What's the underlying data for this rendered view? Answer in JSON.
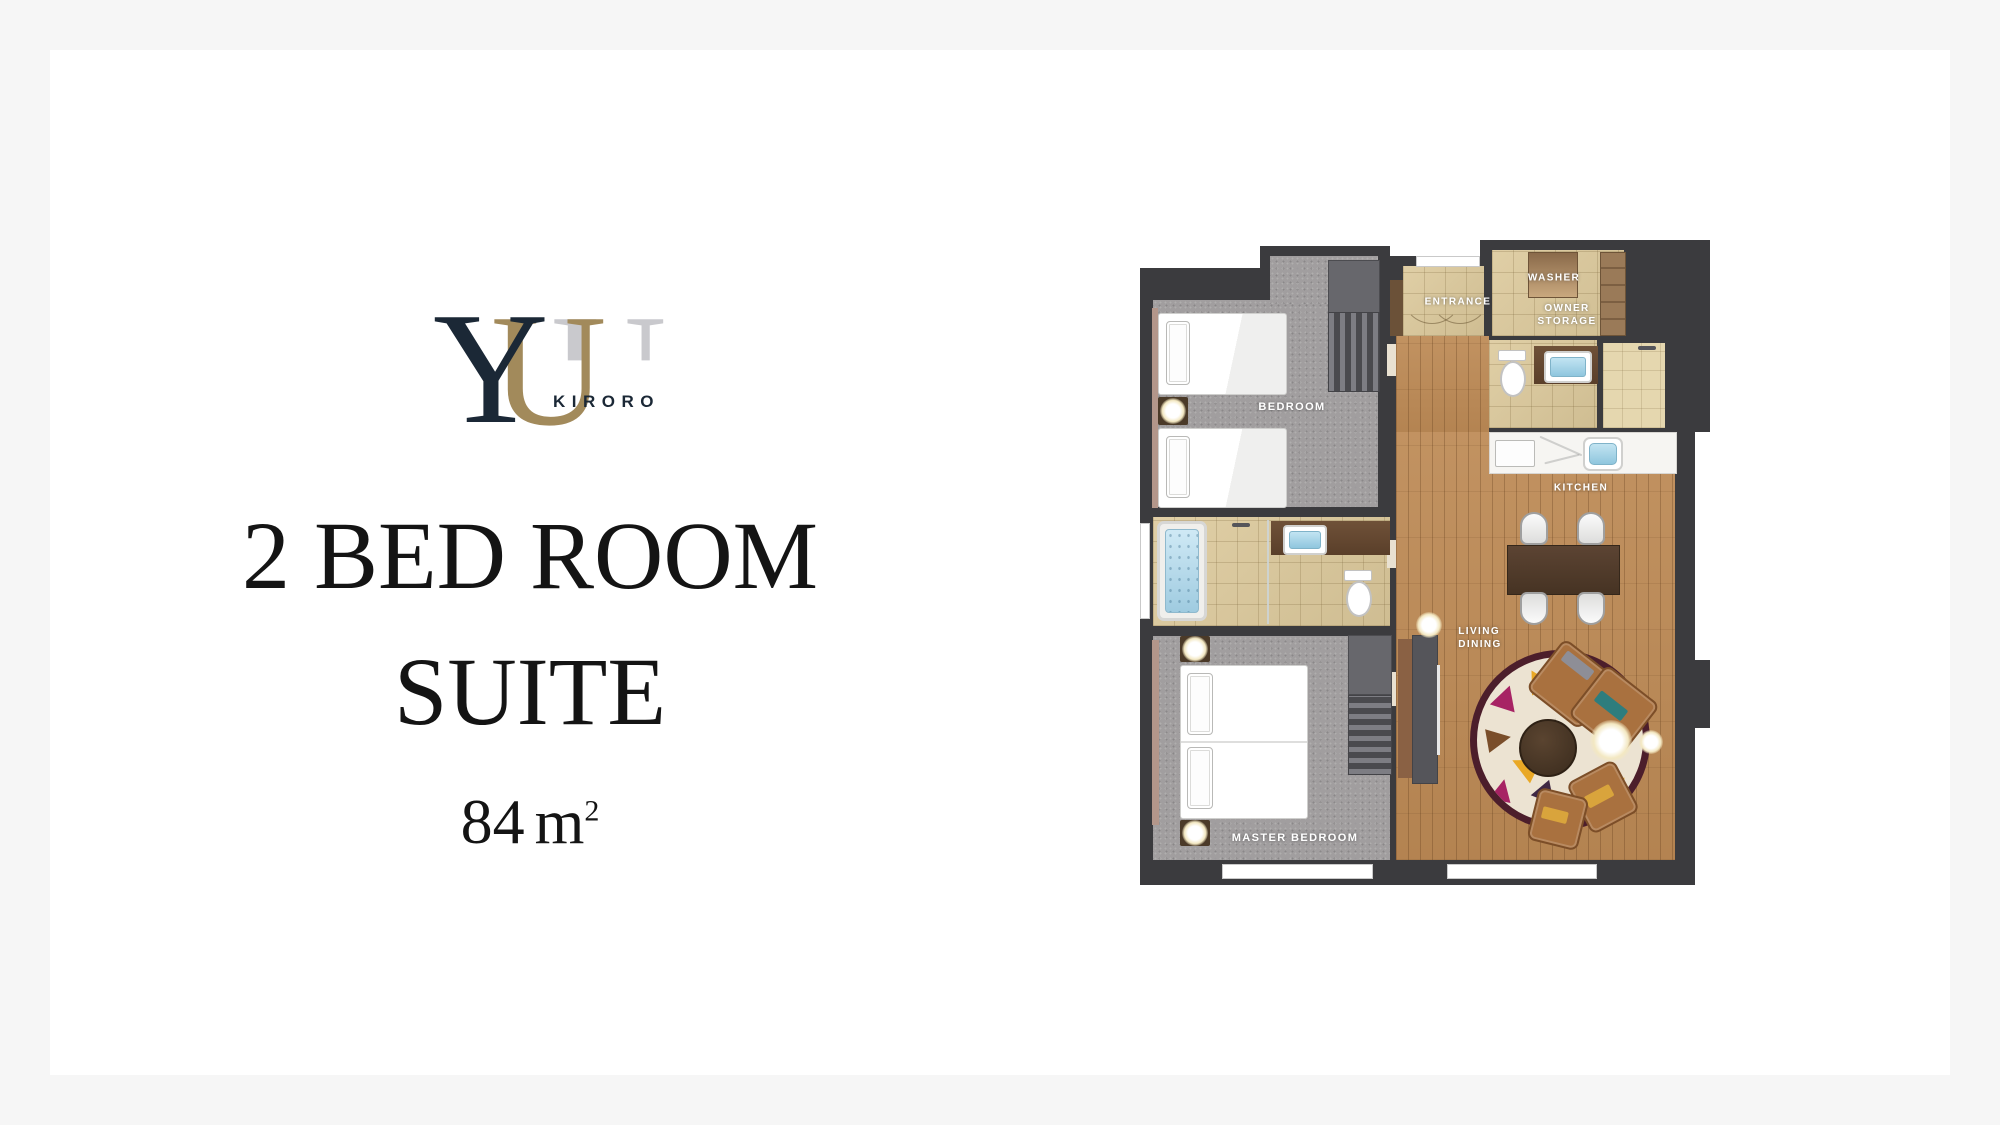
{
  "background": {
    "page_color": "#f6f6f6",
    "card_color": "#ffffff"
  },
  "logo": {
    "y": "Y",
    "u": "U",
    "u_back": "U",
    "brand": "KIRORO",
    "navy": "#1b2836",
    "gold": "#a28a5b",
    "gray": "#c9c9cd"
  },
  "title": {
    "line1": "2 BED ROOM",
    "line2": "SUITE"
  },
  "area": {
    "value": "84",
    "unit": "m",
    "sup": "2"
  },
  "floor_plan": {
    "labels": {
      "bedroom": "BEDROOM",
      "entrance": "ENTRANCE",
      "washer": "WASHER",
      "owner_storage_line1": "OWNER",
      "owner_storage_line2": "STORAGE",
      "kitchen": "KITCHEN",
      "living_line1": "LIVING",
      "living_line2": "DINING",
      "master_bedroom": "MASTER BEDROOM"
    },
    "colors": {
      "wall": "#3b3b3e",
      "wood_floor": "#bd8a55",
      "carpet": "#a19e9f",
      "tile": "#d9c79e",
      "counter": "#f6f5f2",
      "water": "#aad4e6",
      "sofa": "#a9713f",
      "rug_base": "#ece3d2",
      "rug_border": "#4c1e2b",
      "table": "#54402f",
      "label_text": "#ffffff"
    }
  }
}
